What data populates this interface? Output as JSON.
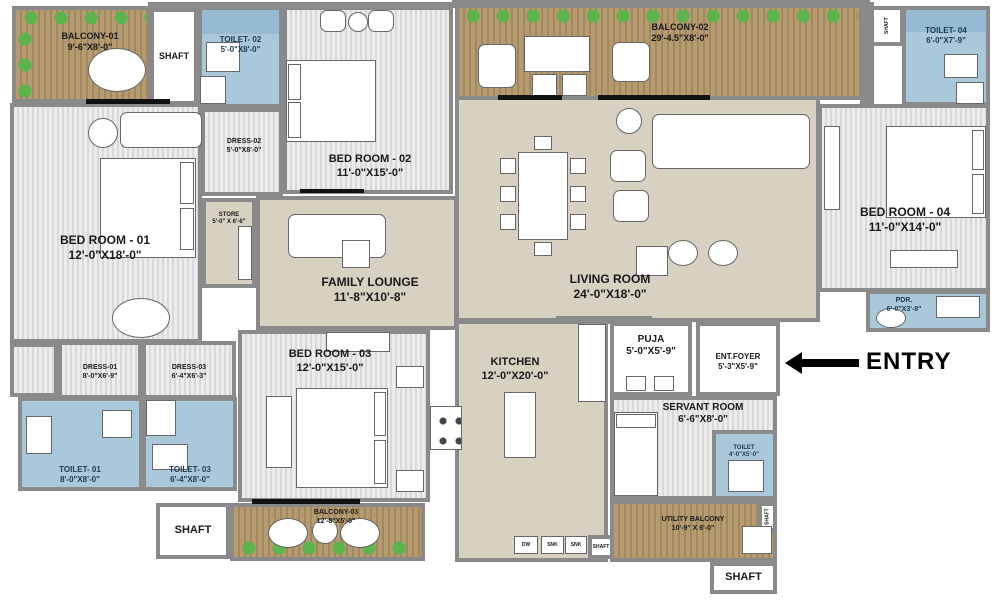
{
  "colors": {
    "wall": "#8a8a8a",
    "ink": "#1a1a1a",
    "toilet_ink": "#1c3a52",
    "beige": "#d7d1c2",
    "stripe_a": "#ececec",
    "stripe_b": "#d9d9d9",
    "wood_a": "#b59b72",
    "wood_b": "#a3885c",
    "blue": "#a9c8da",
    "blue_dark": "#8fb6cd",
    "plant": "#5cb44c"
  },
  "entry": {
    "label": "ENTRY"
  },
  "kitchen_fixtures": {
    "dw": "DW",
    "snk1": "SNK",
    "snk2": "SNK"
  },
  "rooms": {
    "balcony01": {
      "name": "BALCONY-01",
      "dim": "9'-6\"X8'-0\""
    },
    "shaft_tl": {
      "name": "SHAFT"
    },
    "toilet02": {
      "name": "TOILET- 02",
      "dim": "5'-0\"X8'-0\""
    },
    "bedroom02": {
      "name": "BED ROOM - 02",
      "dim": "11'-0\"X15'-0\""
    },
    "dress02": {
      "name": "DRESS-02",
      "dim": "5'-0\"X8'-0\""
    },
    "balcony02": {
      "name": "BALCONY-02",
      "dim": "29'-4.5\"X8'-0\""
    },
    "shaft_tr": {
      "name": "SHAFT"
    },
    "toilet04": {
      "name": "TOILET- 04",
      "dim": "6'-0\"X7'-9\""
    },
    "bedroom01": {
      "name": "BED ROOM - 01",
      "dim": "12'-0\"X18'-0\""
    },
    "store": {
      "name": "STORE",
      "dim": "5'-0\" X 6'-6\""
    },
    "family_lounge": {
      "name": "FAMILY LOUNGE",
      "dim": "11'-8\"X10'-8\""
    },
    "living": {
      "name": "LIVING ROOM",
      "dim": "24'-0\"X18'-0\""
    },
    "bedroom04": {
      "name": "BED ROOM - 04",
      "dim": "11'-0\"X14'-0\""
    },
    "pdr": {
      "name": "PDR.",
      "dim": "6'-0\"X3'-8\""
    },
    "kitchen": {
      "name": "KITCHEN",
      "dim": "12'-0\"X20'-0\""
    },
    "puja": {
      "name": "PUJA",
      "dim": "5'-0\"X5'-9\""
    },
    "ent_foyer": {
      "name": "ENT.FOYER",
      "dim": "5'-3\"X5'-9\""
    },
    "servant": {
      "name": "SERVANT ROOM",
      "dim": "6'-6\"X8'-0\""
    },
    "servant_toilet": {
      "name": "TOILET",
      "dim": "4'-0\"X5'-0\""
    },
    "utility_balcony": {
      "name": "UTILITY BALCONY",
      "dim": "10'-9\" X 6'-0\""
    },
    "shaft_utility": {
      "name": "SHAFT"
    },
    "shaft_br": {
      "name": "SHAFT"
    },
    "shaft_bl": {
      "name": "SHAFT"
    },
    "shaft_kitchen": {
      "name": "SHAFT"
    },
    "dress01": {
      "name": "DRESS-01",
      "dim": "8'-0\"X6'-9\""
    },
    "dress03": {
      "name": "DRESS-03",
      "dim": "6'-4\"X6'-3\""
    },
    "toilet01": {
      "name": "TOILET- 01",
      "dim": "8'-0\"X8'-0\""
    },
    "toilet03": {
      "name": "TOILET- 03",
      "dim": "6'-4\"X8'-0\""
    },
    "bedroom03": {
      "name": "BED ROOM - 03",
      "dim": "12'-0\"X15'-0\""
    },
    "balcony03": {
      "name": "BALCONY-03",
      "dim": "12'-8\"X5'-0\""
    }
  }
}
